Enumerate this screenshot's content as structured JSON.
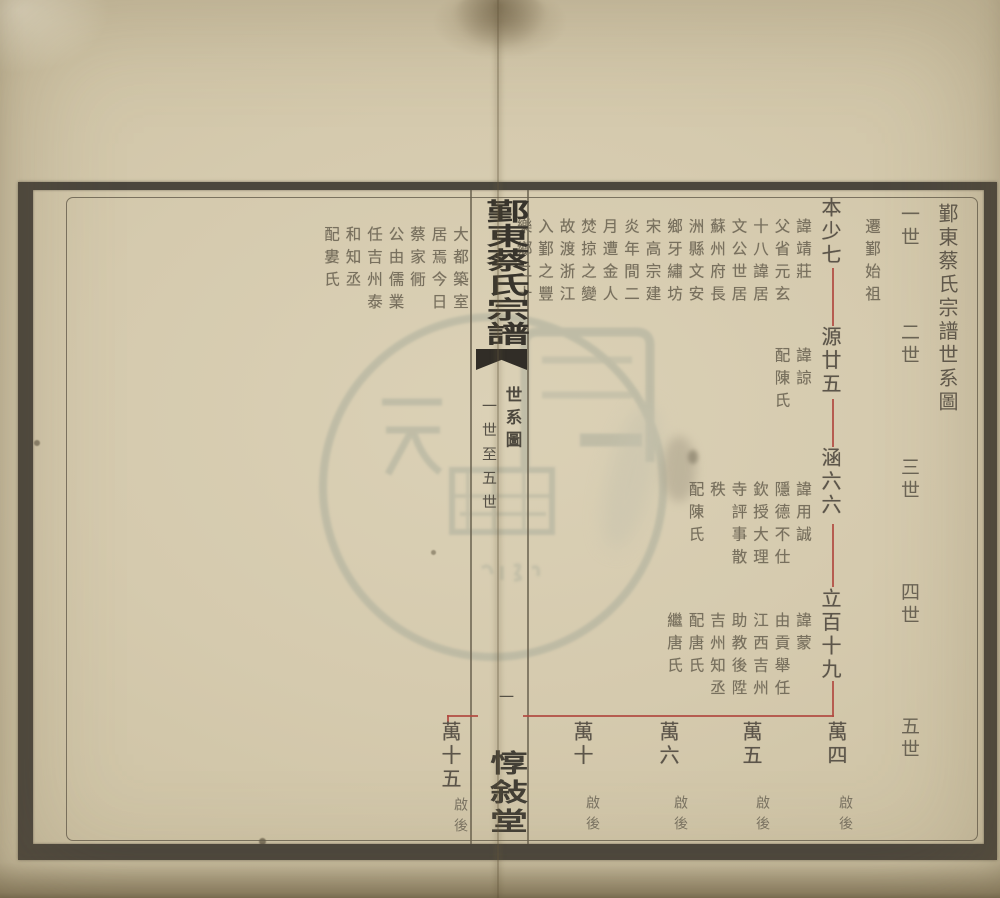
{
  "document": {
    "kind": "clan genealogy chart (scanned woodblock print, two-page spread)",
    "sheet_title": "鄞東蔡氏宗譜世系圖",
    "generation_labels": [
      "一世",
      "二世",
      "三世",
      "四世",
      "五世"
    ],
    "founder_label": "遷鄞始祖"
  },
  "banxin": {
    "book_title": "鄞東蔡氏宗譜",
    "section_title": "世系圖",
    "section_range": "一世至五世",
    "page_number": "一",
    "hall_name": "惇敍堂"
  },
  "tree": {
    "gen1": {
      "name": "本少七",
      "note_cols": [
        "諱靖莊",
        "父省元玄",
        "十八諱居",
        "文公世居",
        "蘇州府長",
        "洲縣文安",
        "鄉牙繡坊",
        "宋高宗建",
        "炎年間二",
        "月遭金人",
        "焚掠之變",
        "故渡浙江",
        "入鄞之豐",
        "樂鄉二十"
      ],
      "note_left_cols": [
        "大都築室",
        "居焉今日",
        "蔡家衕",
        "公由儒業",
        "任吉州泰",
        "和知丞",
        "配婁氏"
      ]
    },
    "gen2": {
      "name": "源廿五",
      "note_cols": [
        "諱諒",
        "配陳氏"
      ]
    },
    "gen3": {
      "name": "涵六六",
      "note_cols": [
        "諱用誠",
        "隱德不仕",
        "欽授大理",
        "寺評事散",
        "秩",
        "配陳氏"
      ]
    },
    "gen4": {
      "name": "立百十九",
      "note_cols": [
        "諱蒙",
        "由貢舉任",
        "江西吉州",
        "助教後陞",
        "吉州知丞",
        "配唐氏",
        "繼唐氏"
      ]
    },
    "gen5": {
      "members": [
        {
          "name": "萬四",
          "note": "啟後"
        },
        {
          "name": "萬五",
          "note": "啟後"
        },
        {
          "name": "萬六",
          "note": "啟後"
        },
        {
          "name": "萬十",
          "note": "啟後"
        },
        {
          "name": "萬十五",
          "note": "啟後"
        }
      ]
    }
  },
  "colors": {
    "paper": "#d5caae",
    "frame_border": "#4b463d",
    "red_line": "#b0493f",
    "ink": "#6f6857",
    "stamp": "#a7ab9a"
  }
}
